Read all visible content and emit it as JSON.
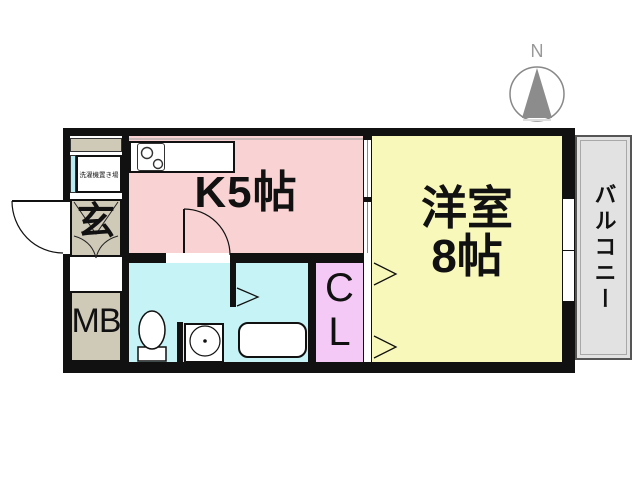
{
  "compass": {
    "label": "N"
  },
  "plan": {
    "kitchen": {
      "label": "K5帖",
      "color": "#f9d3d3"
    },
    "western_room": {
      "label": "洋室8帖",
      "line1": "洋室",
      "line2": "8帖",
      "color": "#f8f8bb"
    },
    "closet": {
      "label": "CL",
      "line1": "C",
      "line2": "L",
      "color": "#f5c9f5"
    },
    "entrance": {
      "label": "玄",
      "color": "#cfc9b8"
    },
    "meter_box": {
      "label": "MB",
      "color": "#cfc9b8"
    },
    "laundry": {
      "label": "洗濯機置き場"
    },
    "bathroom": {
      "color": "#c6f3f5"
    },
    "balcony": {
      "label": "バルコニー",
      "color": "#e2e2e2"
    },
    "wall_color": "#111111"
  }
}
